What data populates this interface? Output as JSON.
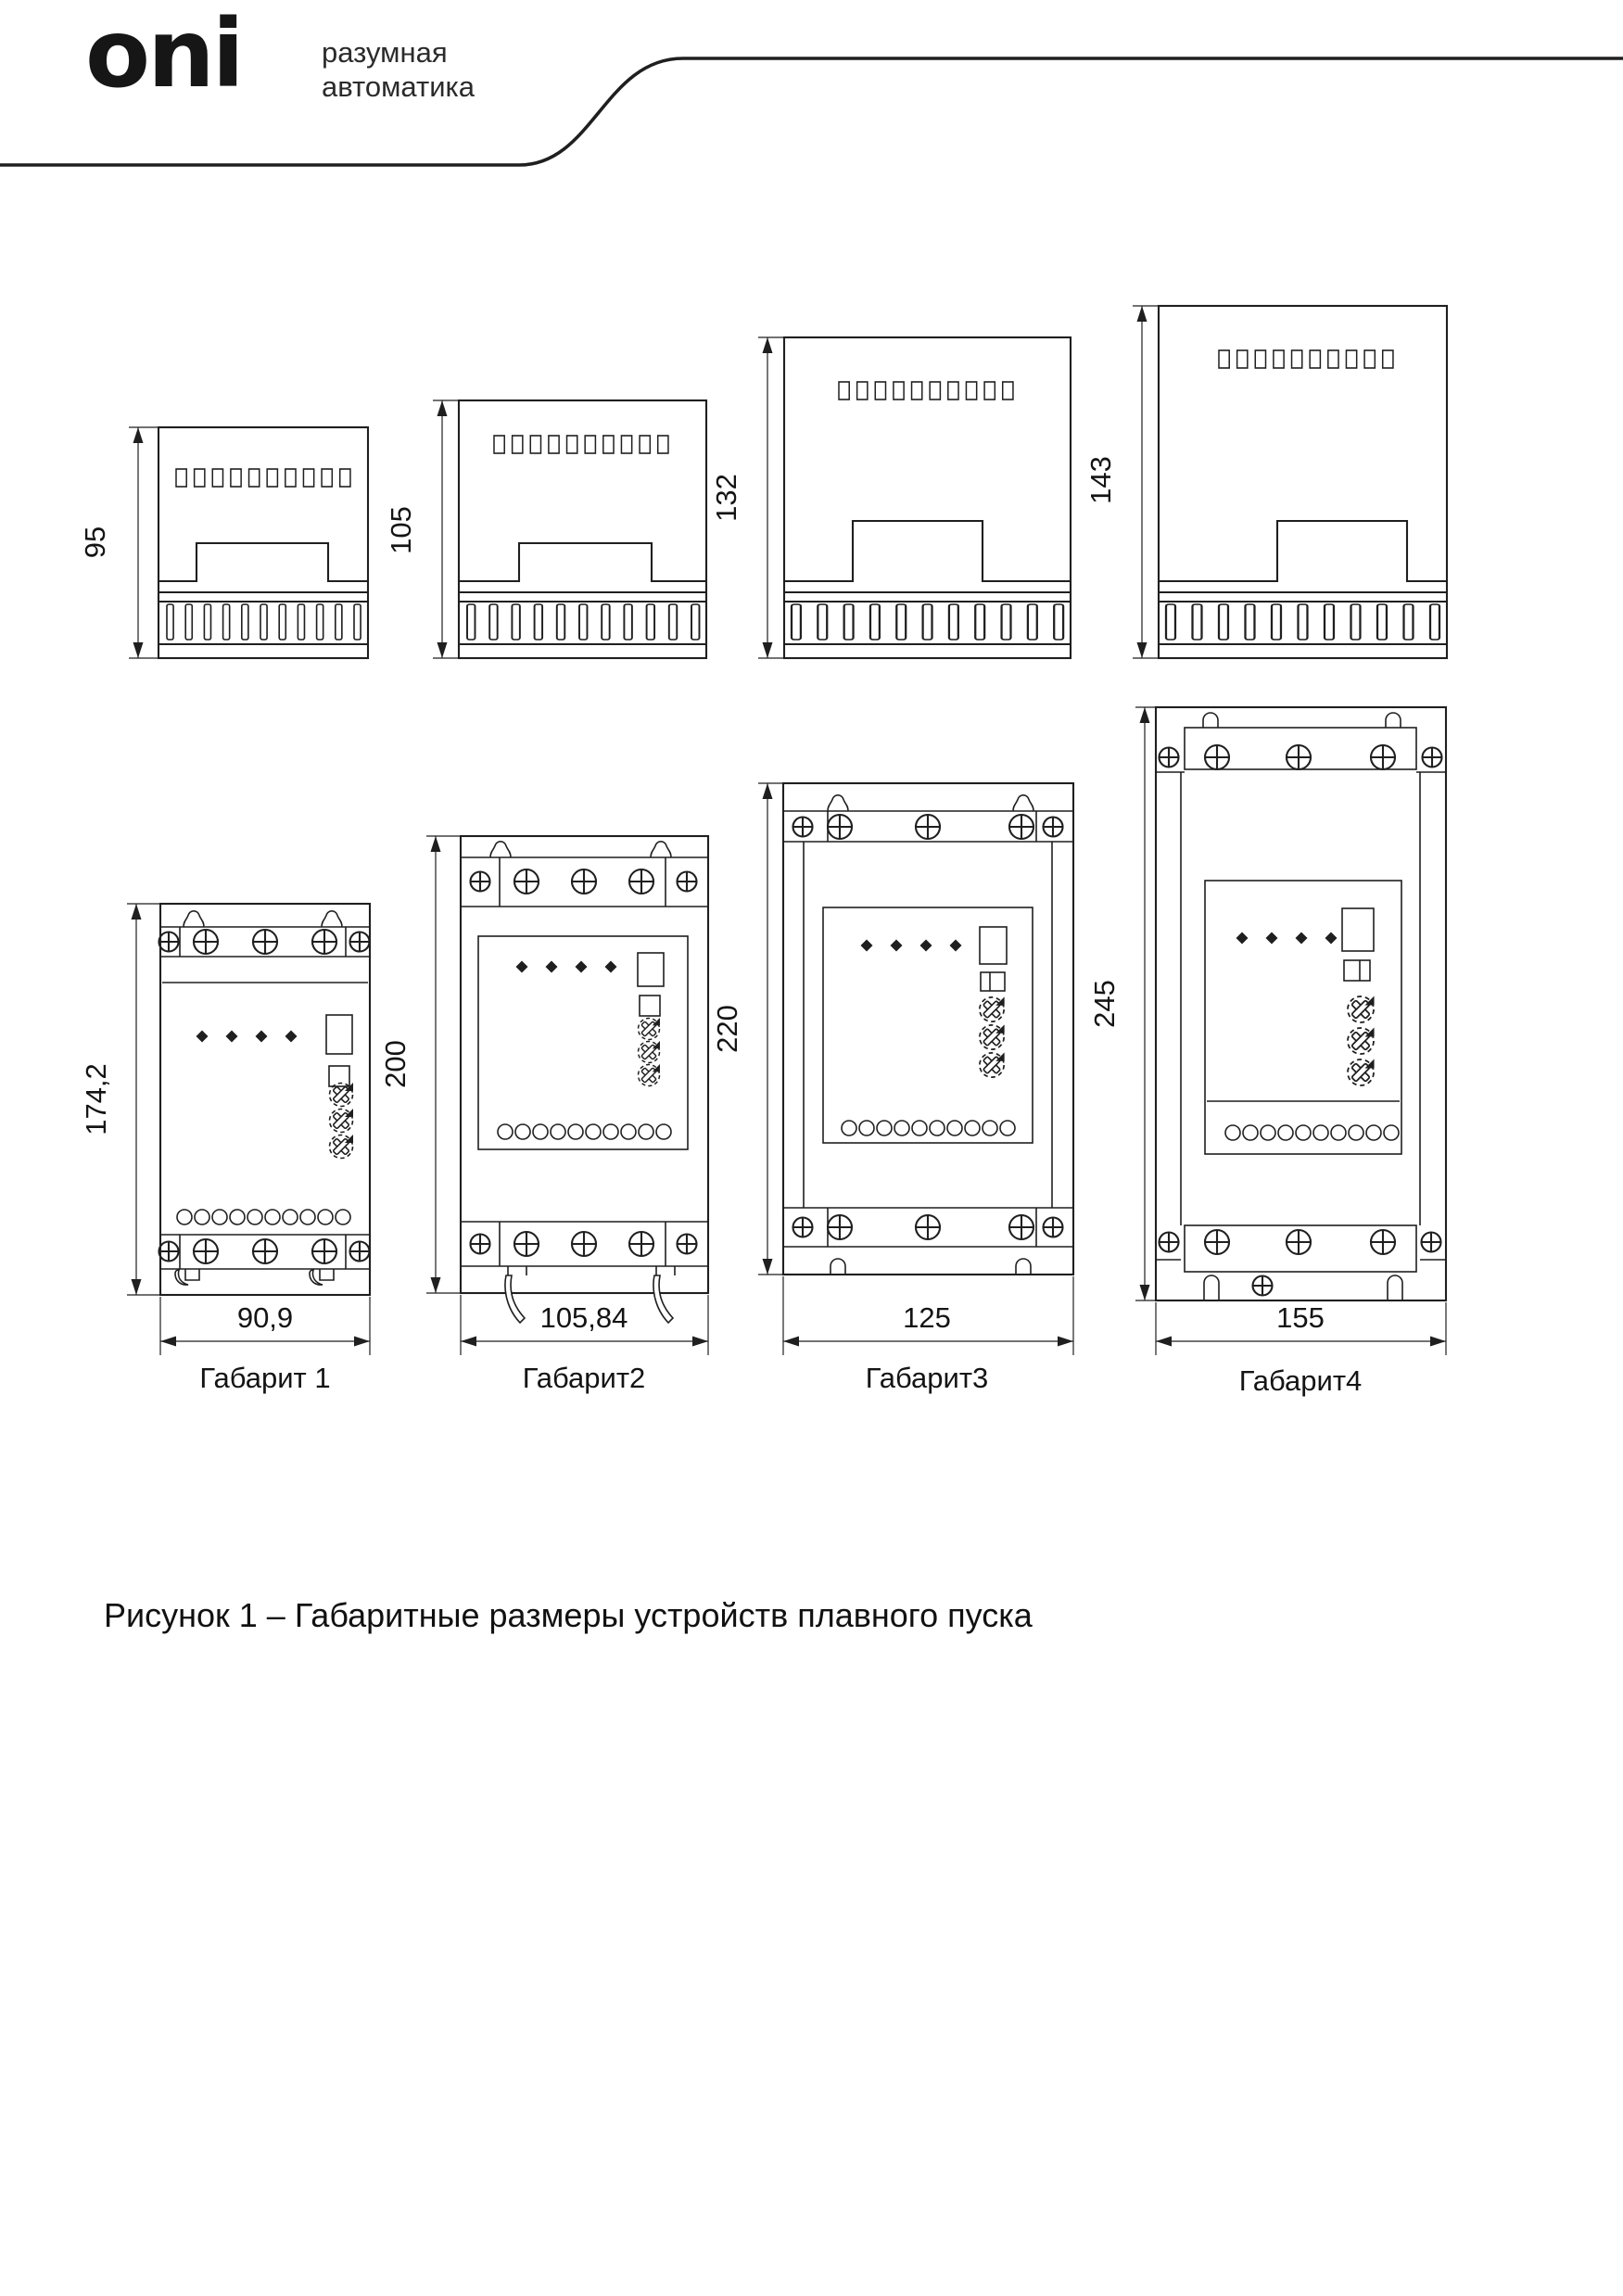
{
  "header": {
    "logo": "oni",
    "tagline1": "разумная",
    "tagline2": "автоматика"
  },
  "figure": {
    "caption": "Рисунок 1 – Габаритные размеры устройств плавного пуска",
    "side_views": [
      {
        "height_label": "95"
      },
      {
        "height_label": "105"
      },
      {
        "height_label": "132"
      },
      {
        "height_label": "143"
      }
    ],
    "front_views": [
      {
        "name": "Габарит 1",
        "height_label": "174,2",
        "width_label": "90,9"
      },
      {
        "name": "Габарит2",
        "height_label": "200",
        "width_label": "105,84"
      },
      {
        "name": "Габарит3",
        "height_label": "220",
        "width_label": "125"
      },
      {
        "name": "Габарит4",
        "height_label": "245",
        "width_label": "155"
      }
    ]
  },
  "colors": {
    "line": "#1f1f1f",
    "background": "#ffffff",
    "text": "#141414"
  }
}
